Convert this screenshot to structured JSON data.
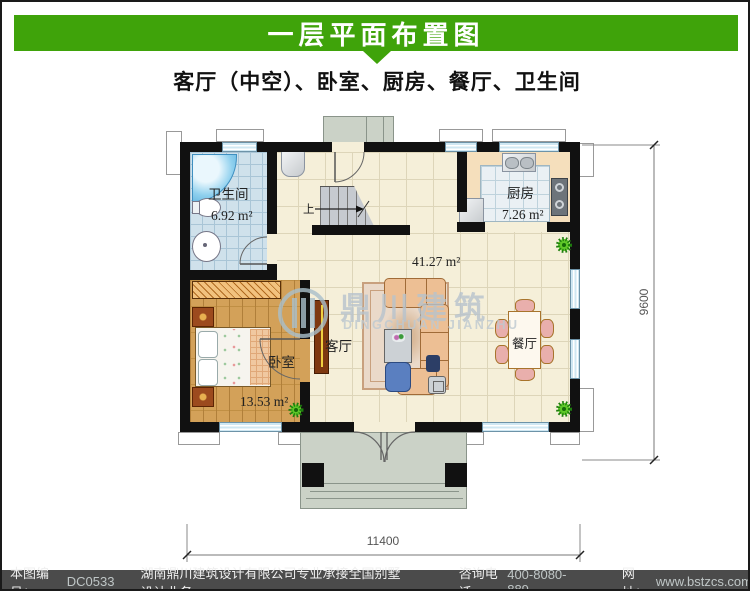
{
  "header": {
    "title": "一层平面布置图",
    "accent_color": "#3fa30a"
  },
  "subtitle": "客厅（中空）、卧室、厨房、餐厅、卫生间",
  "plan": {
    "rooms": {
      "bathroom": {
        "label": "卫生间",
        "area": "6.92 m²"
      },
      "kitchen": {
        "label": "厨房",
        "area": "7.26 m²"
      },
      "living": {
        "label": "客厅",
        "area": "41.27 m²"
      },
      "bedroom": {
        "label": "卧室",
        "area": "13.53 m²"
      },
      "dining": {
        "label": "餐厅"
      }
    },
    "stairs": {
      "label": "上"
    },
    "dimensions": {
      "width_mm": "11400",
      "height_mm": "9600"
    }
  },
  "watermark": {
    "name_cn": "鼎川建筑",
    "name_en": "DINGCHUAN JIANZHU"
  },
  "footer": {
    "number_label": "本图编号：",
    "number": "DC0533",
    "company": "湖南鼎川建筑设计有限公司专业承接全国别墅设计业务",
    "phone_label": "咨询电话:",
    "phone": "400-8080-889",
    "web_label": "网址：",
    "website": "www.bstzcs.com",
    "bg_color": "#4b4b4b"
  }
}
